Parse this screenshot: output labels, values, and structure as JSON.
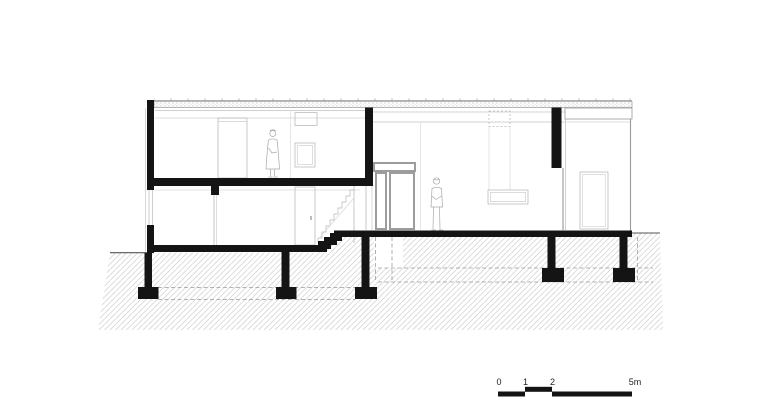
{
  "page": {
    "background": "#ffffff"
  },
  "drawing": {
    "kind": "architectural cross-section",
    "ink_color": "#141414",
    "line_color": "#a8a8a8",
    "faint_line_color": "#d6d6d6",
    "hatch_color": "#cdcdcd",
    "figures": [
      "standing-woman-upper-floor",
      "standing-man-at-entrance"
    ]
  },
  "scale_bar": {
    "labels": [
      "0",
      "1",
      "2",
      "5m"
    ]
  }
}
